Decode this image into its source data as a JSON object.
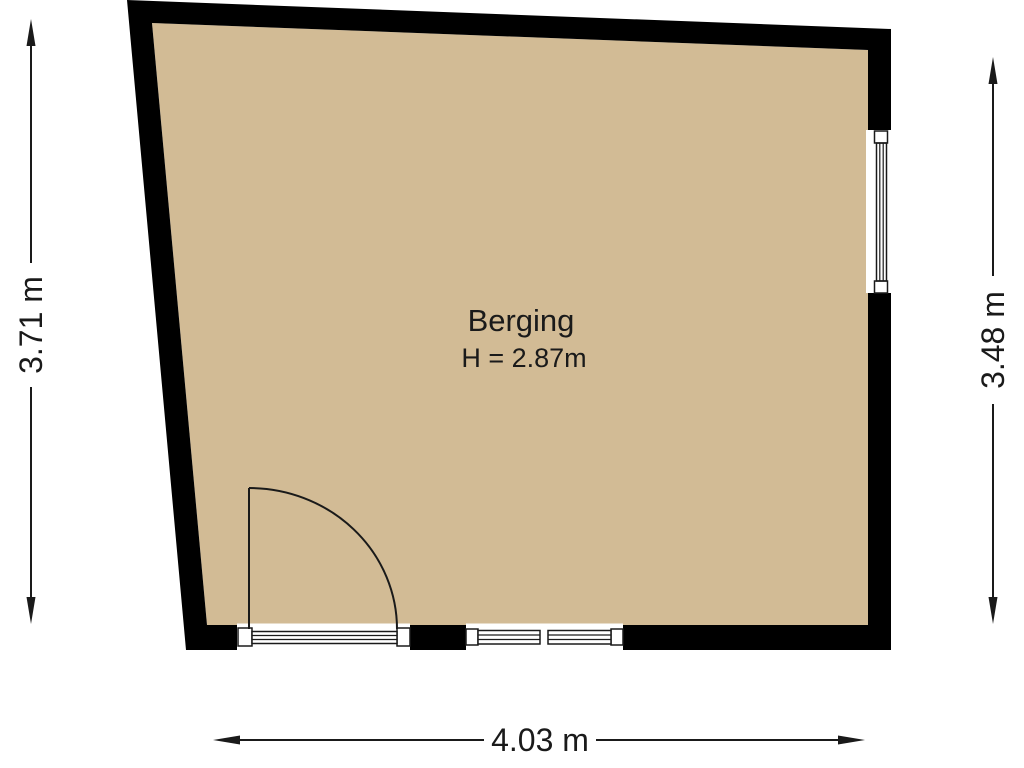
{
  "floorplan": {
    "room": {
      "name": "Berging",
      "ceiling_height": "H = 2.87m"
    },
    "dimensions": {
      "left": "3.71 m",
      "right": "3.48 m",
      "bottom": "4.03 m"
    },
    "colors": {
      "floor": "#D2BB95",
      "wall": "#000000",
      "line": "#1A1A1A",
      "background": "#FFFFFF"
    }
  }
}
